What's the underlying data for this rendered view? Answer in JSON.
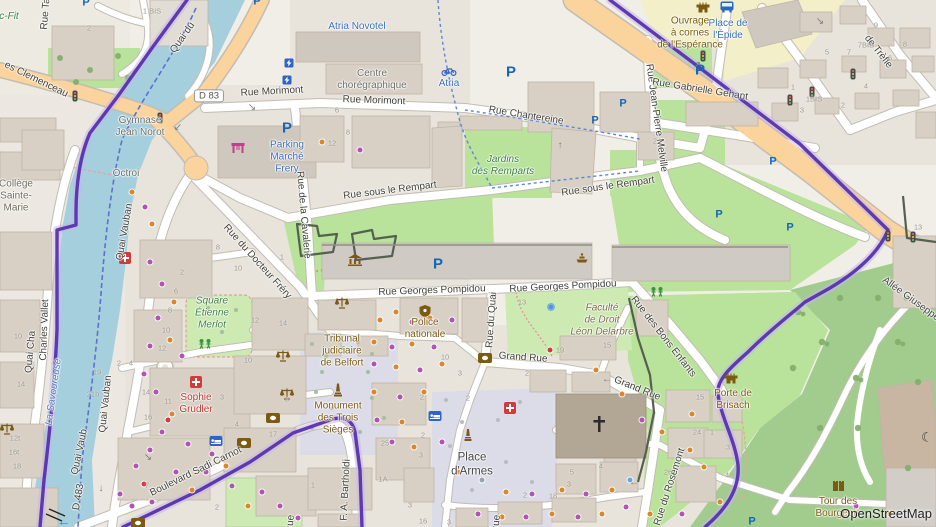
{
  "map": {
    "place": "Belfort centre-ville",
    "attribution": "OpenStreetMap"
  },
  "palette": {
    "land": "#f1eee7",
    "residential": "#e8e4dc",
    "water": "#a5cfdd",
    "park": "#b9e29b",
    "park_pale": "#cdeab2",
    "forest": "#a2cb8e",
    "pedestrian": "#dcdce8",
    "road_orange": "#fbd39c",
    "road_casing": "#c2bcb2",
    "building": "#d8d0c5",
    "building_outline": "#c0b4a4",
    "boundary_purple": "#5732ad",
    "boundary_halo": "#c7b6e9",
    "education": "#f3efc8",
    "accent_blue": "#2f63c4",
    "poi_brown": "#7c5a12",
    "poi_green": "#3d8040",
    "poi_red": "#c03535",
    "label_blue": "#3a6fb5",
    "water_label": "#4d80b3"
  },
  "labels": [
    {
      "t": "Quai du",
      "x": 183,
      "y": 38,
      "r": -55
    },
    {
      "t": "Rue Ta",
      "x": 46,
      "y": 14,
      "r": -85
    },
    {
      "t": "es Clemenceau",
      "x": 36,
      "y": 80,
      "r": 26
    },
    {
      "t": "Rue Morimont",
      "x": 272,
      "y": 92,
      "r": -3
    },
    {
      "t": "Rue Morimont",
      "x": 374,
      "y": 101,
      "r": 2
    },
    {
      "t": "Rue Chantereine",
      "x": 526,
      "y": 116,
      "r": 9
    },
    {
      "t": "Rue sous le Rempart",
      "x": 390,
      "y": 191,
      "r": -7
    },
    {
      "t": "Rue sous le Rempart",
      "x": 608,
      "y": 187,
      "r": -8
    },
    {
      "t": "Rue de la Cavalerie",
      "x": 303,
      "y": 215,
      "r": 85
    },
    {
      "t": "Rue du Docteur Fréry",
      "x": 257,
      "y": 262,
      "r": 48
    },
    {
      "t": "Quai Vauban",
      "x": 125,
      "y": 232,
      "r": -80
    },
    {
      "t": "Quai Vauban",
      "x": 106,
      "y": 404,
      "r": -84
    },
    {
      "t": "Quai Vaub",
      "x": 80,
      "y": 452,
      "r": -78
    },
    {
      "t": "Charles Vallet",
      "x": 45,
      "y": 330,
      "r": -88
    },
    {
      "t": "Quai Cha",
      "x": 31,
      "y": 352,
      "r": -85
    },
    {
      "t": "D 483",
      "x": 79,
      "y": 497,
      "r": -80
    },
    {
      "t": "Rue Georges Pompidou",
      "x": 432,
      "y": 291,
      "r": -2
    },
    {
      "t": "Rue Georges Pompidou",
      "x": 563,
      "y": 287,
      "r": -3
    },
    {
      "t": "Rue du Quai",
      "x": 492,
      "y": 320,
      "r": -86
    },
    {
      "t": "Grand Rue",
      "x": 523,
      "y": 358,
      "r": 4
    },
    {
      "t": "Grand Rue",
      "x": 637,
      "y": 389,
      "r": 22
    },
    {
      "t": "Rue des Bons Enfants",
      "x": 663,
      "y": 337,
      "r": 52
    },
    {
      "t": "Boulevard Sadi Carnot",
      "x": 196,
      "y": 472,
      "r": -26
    },
    {
      "t": "F. A. Bartholdi",
      "x": 346,
      "y": 490,
      "r": -87
    },
    {
      "t": "Rue du Rosemont",
      "x": 670,
      "y": 487,
      "r": -72
    },
    {
      "t": "Allée Giuseppe Garibaldi",
      "x": 928,
      "y": 312,
      "r": 36
    },
    {
      "t": "Rue Jean-Pierre Melville",
      "x": 656,
      "y": 118,
      "r": 82
    },
    {
      "t": "Rue Gabrielle Gehant",
      "x": 700,
      "y": 90,
      "r": 9
    },
    {
      "t": "de Trèfle",
      "x": 878,
      "y": 52,
      "r": 52
    },
    {
      "t": "Rue",
      "x": 291,
      "y": 524,
      "r": -85
    },
    {
      "t": "Rue",
      "x": 497,
      "y": 524,
      "r": -85
    },
    {
      "t": "Octroi",
      "x": 126,
      "y": 174,
      "c": "gray"
    },
    {
      "t": "Gymnase\nJean Norot",
      "x": 140,
      "y": 127,
      "c": "gray"
    },
    {
      "t": "Collège\nSainte-\nMarie",
      "x": 16,
      "y": 196,
      "c": "gray"
    },
    {
      "t": "Centre\nchorégraphique",
      "x": 372,
      "y": 80,
      "c": "gray"
    },
    {
      "t": "Atria Novotel",
      "x": 357,
      "y": 27,
      "c": "blue"
    },
    {
      "t": "Atria",
      "x": 449,
      "y": 84,
      "c": "blue"
    },
    {
      "t": "Parking\nMarché\nFrery",
      "x": 287,
      "y": 157,
      "c": "blue"
    },
    {
      "t": "Place de\nl'Épide",
      "x": 728,
      "y": 30,
      "c": "blue"
    },
    {
      "t": "Ouvrage\nà cornes\nde l'Espérance",
      "x": 690,
      "y": 33,
      "c": "brown"
    },
    {
      "t": "Jardins\ndes Remparts",
      "x": 503,
      "y": 166,
      "c": "green"
    },
    {
      "t": "Square\nÉtienne\nMerlot",
      "x": 212,
      "y": 313,
      "c": "green"
    },
    {
      "t": "c-Fit",
      "x": 9,
      "y": 17,
      "c": "green"
    },
    {
      "t": "La Savoureuse",
      "x": 54,
      "y": 392,
      "r": -82,
      "c": "waterlbl"
    },
    {
      "t": "Tribunal\njudiciaire\nde Belfort",
      "x": 342,
      "y": 351,
      "c": "brown"
    },
    {
      "t": "Police\nnationale",
      "x": 425,
      "y": 329,
      "c": "brown"
    },
    {
      "t": "Monument\ndes Trois\nSièges",
      "x": 338,
      "y": 418,
      "c": "brown"
    },
    {
      "t": "Sophie\nGrudler",
      "x": 196,
      "y": 404,
      "c": "red"
    },
    {
      "t": "Place\nd'Armes",
      "x": 472,
      "y": 465,
      "c": "dark"
    },
    {
      "t": "Porte de\nBrisach",
      "x": 733,
      "y": 400,
      "c": "brown"
    },
    {
      "t": "Tour des\nBourgeois",
      "x": 838,
      "y": 508,
      "c": "brown"
    },
    {
      "t": "Faculté\nde Droit\nLéon Delarbre",
      "x": 602,
      "y": 320,
      "c": "univ"
    },
    {
      "t": "D 83",
      "x": 209,
      "y": 96,
      "c": "shield"
    }
  ],
  "house_numbers": [
    [
      152,
      11,
      "1 BIS"
    ],
    [
      89,
      28,
      "2"
    ],
    [
      876,
      25,
      "9"
    ],
    [
      905,
      44,
      "8"
    ],
    [
      866,
      45,
      "7BIS"
    ],
    [
      849,
      52,
      "7"
    ],
    [
      827,
      52,
      "5"
    ],
    [
      890,
      58,
      "6"
    ],
    [
      866,
      86,
      "4"
    ],
    [
      793,
      87,
      "1"
    ],
    [
      814,
      99,
      "1BIS"
    ],
    [
      802,
      110,
      "3"
    ],
    [
      843,
      105,
      "2"
    ],
    [
      918,
      227,
      "13"
    ],
    [
      655,
      141,
      "2"
    ],
    [
      337,
      110,
      "6"
    ],
    [
      348,
      132,
      "8"
    ],
    [
      332,
      143,
      "12"
    ],
    [
      218,
      247,
      "8"
    ],
    [
      282,
      257,
      "1"
    ],
    [
      238,
      268,
      "10"
    ],
    [
      255,
      320,
      "12"
    ],
    [
      283,
      323,
      "14"
    ],
    [
      182,
      272,
      "2"
    ],
    [
      176,
      291,
      "6"
    ],
    [
      170,
      310,
      "8"
    ],
    [
      166,
      330,
      "10"
    ],
    [
      162,
      348,
      "12"
    ],
    [
      18,
      336,
      "10"
    ],
    [
      21,
      384,
      "14"
    ],
    [
      15,
      438,
      "12t"
    ],
    [
      14,
      452,
      "16t"
    ],
    [
      17,
      466,
      "18"
    ],
    [
      97,
      372,
      "19"
    ],
    [
      93,
      394,
      "21b"
    ],
    [
      146,
      392,
      "14"
    ],
    [
      168,
      401,
      "11"
    ],
    [
      148,
      417,
      "16"
    ],
    [
      222,
      397,
      "3"
    ],
    [
      119,
      363,
      "2"
    ],
    [
      131,
      363,
      "4"
    ],
    [
      248,
      360,
      "10"
    ],
    [
      287,
      399,
      "3"
    ],
    [
      237,
      424,
      "4"
    ],
    [
      273,
      434,
      "17"
    ],
    [
      147,
      485,
      "7"
    ],
    [
      217,
      507,
      "2"
    ],
    [
      313,
      485,
      "1"
    ],
    [
      423,
      435,
      "2"
    ],
    [
      385,
      443,
      "25"
    ],
    [
      421,
      455,
      "3"
    ],
    [
      383,
      479,
      "1A"
    ],
    [
      410,
      505,
      "3"
    ],
    [
      423,
      521,
      "16"
    ],
    [
      449,
      522,
      "3"
    ],
    [
      525,
      495,
      "2"
    ],
    [
      553,
      496,
      "18"
    ],
    [
      569,
      484,
      "3"
    ],
    [
      572,
      472,
      "5"
    ],
    [
      601,
      466,
      "4"
    ],
    [
      445,
      357,
      "10"
    ],
    [
      422,
      397,
      "2"
    ],
    [
      460,
      373,
      "3"
    ],
    [
      468,
      398,
      "2"
    ],
    [
      527,
      373,
      "2"
    ],
    [
      522,
      302,
      "13"
    ],
    [
      560,
      350,
      "19"
    ],
    [
      607,
      345,
      "15"
    ],
    [
      700,
      397,
      "15"
    ],
    [
      697,
      432,
      "24"
    ],
    [
      712,
      432,
      "1"
    ],
    [
      728,
      447,
      "3"
    ],
    [
      668,
      472,
      "26"
    ],
    [
      727,
      475,
      "4"
    ]
  ],
  "icons": [
    [
      "parking",
      287,
      128,
      1.35
    ],
    [
      "parking",
      86,
      3,
      1
    ],
    [
      "parking",
      257,
      2,
      1
    ],
    [
      "parking",
      511,
      72,
      1.2
    ],
    [
      "parking",
      700,
      70,
      1.2
    ],
    [
      "parking",
      595,
      121,
      1
    ],
    [
      "parking",
      623,
      104,
      1
    ],
    [
      "parking",
      438,
      264,
      1.2
    ],
    [
      "parking",
      719,
      215,
      1
    ],
    [
      "parking",
      773,
      162,
      1
    ],
    [
      "parking",
      790,
      228,
      1
    ],
    [
      "parking",
      752,
      522,
      1
    ],
    [
      "charging",
      289,
      64
    ],
    [
      "charging",
      287,
      81
    ],
    [
      "bus",
      727,
      7
    ],
    [
      "bike",
      449,
      71
    ],
    [
      "market",
      238,
      148
    ],
    [
      "museum",
      355,
      260
    ],
    [
      "fountain",
      582,
      258
    ],
    [
      "bluedot",
      551,
      307
    ],
    [
      "playground",
      657,
      292
    ],
    [
      "playground",
      205,
      344
    ],
    [
      "pharmacy",
      196,
      382
    ],
    [
      "pharmacy",
      510,
      408
    ],
    [
      "pharmacy",
      125,
      258
    ],
    [
      "bank",
      273,
      418
    ],
    [
      "bank",
      244,
      443
    ],
    [
      "bank",
      485,
      358
    ],
    [
      "bank",
      138,
      523
    ],
    [
      "hotel",
      435,
      416
    ],
    [
      "hotel",
      216,
      441
    ],
    [
      "scales",
      342,
      303
    ],
    [
      "scales",
      283,
      356
    ],
    [
      "scales",
      287,
      394
    ],
    [
      "scales",
      7,
      429
    ],
    [
      "police",
      425,
      311
    ],
    [
      "monument",
      338,
      390
    ],
    [
      "obelisk",
      468,
      435
    ],
    [
      "castle",
      703,
      6
    ],
    [
      "castle",
      731,
      377
    ],
    [
      "tower",
      838,
      485
    ],
    [
      "crescent",
      927,
      437
    ],
    [
      "cross",
      599,
      424
    ],
    [
      "tl",
      75,
      96
    ],
    [
      "tl",
      160,
      118
    ],
    [
      "tl",
      703,
      56
    ],
    [
      "tl",
      790,
      100
    ],
    [
      "tl",
      812,
      92
    ],
    [
      "tl",
      853,
      74
    ],
    [
      "tl",
      888,
      236
    ],
    [
      "tl",
      913,
      237
    ],
    [
      "arrow",
      252,
      108,
      "↘"
    ],
    [
      "arrow",
      178,
      128,
      "↙"
    ],
    [
      "arrow",
      697,
      66,
      "↗"
    ],
    [
      "arrow",
      607,
      380,
      "←"
    ],
    [
      "arrow",
      634,
      483,
      "←"
    ],
    [
      "arrow",
      101,
      489,
      "↓"
    ],
    [
      "arrow",
      148,
      458,
      "↘"
    ],
    [
      "arrow",
      820,
      22,
      "↘"
    ],
    [
      "arrow",
      560,
      146,
      "↑"
    ],
    [
      "arrowb",
      64,
      521,
      "←"
    ]
  ],
  "poi_dots": [
    [
      150,
      262,
      "p"
    ],
    [
      162,
      284,
      "p"
    ],
    [
      174,
      302,
      "o"
    ],
    [
      158,
      318,
      "p"
    ],
    [
      170,
      340,
      "o"
    ],
    [
      182,
      356,
      "p"
    ],
    [
      150,
      346,
      "p"
    ],
    [
      144,
      374,
      "p"
    ],
    [
      156,
      392,
      "p"
    ],
    [
      172,
      414,
      "o"
    ],
    [
      162,
      432,
      "p"
    ],
    [
      150,
      450,
      "p"
    ],
    [
      136,
      466,
      "p"
    ],
    [
      144,
      484,
      "r"
    ],
    [
      152,
      502,
      "p"
    ],
    [
      132,
      506,
      "p"
    ],
    [
      120,
      494,
      "p"
    ],
    [
      176,
      472,
      "p"
    ],
    [
      192,
      490,
      "o"
    ],
    [
      206,
      472,
      "p"
    ],
    [
      212,
      454,
      "p"
    ],
    [
      226,
      466,
      "o"
    ],
    [
      168,
      420,
      "r"
    ],
    [
      188,
      444,
      "p"
    ],
    [
      232,
      486,
      "p"
    ],
    [
      248,
      506,
      "o"
    ],
    [
      262,
      492,
      "p"
    ],
    [
      280,
      506,
      "p"
    ],
    [
      298,
      518,
      "p"
    ],
    [
      322,
      142,
      "o"
    ],
    [
      360,
      150,
      "p"
    ],
    [
      396,
      312,
      "o"
    ],
    [
      412,
      322,
      "p"
    ],
    [
      380,
      320,
      "o"
    ],
    [
      430,
      318,
      "o"
    ],
    [
      452,
      320,
      "p"
    ],
    [
      374,
      342,
      "o"
    ],
    [
      392,
      347,
      "p"
    ],
    [
      412,
      344,
      "o"
    ],
    [
      434,
      347,
      "p"
    ],
    [
      374,
      364,
      "p"
    ],
    [
      396,
      367,
      "o"
    ],
    [
      420,
      370,
      "p"
    ],
    [
      442,
      364,
      "o"
    ],
    [
      374,
      392,
      "o"
    ],
    [
      400,
      397,
      "p"
    ],
    [
      424,
      392,
      "o"
    ],
    [
      377,
      420,
      "p"
    ],
    [
      402,
      422,
      "o"
    ],
    [
      392,
      442,
      "p"
    ],
    [
      414,
      447,
      "o"
    ],
    [
      442,
      442,
      "p"
    ],
    [
      458,
      472,
      "o"
    ],
    [
      482,
      480,
      "g"
    ],
    [
      506,
      492,
      "o"
    ],
    [
      532,
      494,
      "p"
    ],
    [
      562,
      490,
      "o"
    ],
    [
      586,
      494,
      "p"
    ],
    [
      612,
      490,
      "o"
    ],
    [
      550,
      350,
      "r"
    ],
    [
      596,
      370,
      "o"
    ],
    [
      622,
      394,
      "o"
    ],
    [
      642,
      420,
      "p"
    ],
    [
      662,
      432,
      "o"
    ],
    [
      692,
      414,
      "o"
    ],
    [
      690,
      450,
      "o"
    ],
    [
      704,
      467,
      "o"
    ],
    [
      720,
      502,
      "o"
    ],
    [
      682,
      514,
      "p"
    ],
    [
      650,
      514,
      "o"
    ],
    [
      626,
      507,
      "p"
    ],
    [
      602,
      514,
      "o"
    ],
    [
      578,
      517,
      "p"
    ],
    [
      552,
      514,
      "o"
    ],
    [
      526,
      517,
      "p"
    ],
    [
      502,
      517,
      "o"
    ],
    [
      478,
      514,
      "p"
    ],
    [
      856,
      506,
      "p"
    ],
    [
      890,
      514,
      "o"
    ],
    [
      630,
      480,
      "b"
    ],
    [
      132,
      192,
      "o"
    ],
    [
      145,
      207,
      "p"
    ],
    [
      152,
      224,
      "o"
    ]
  ]
}
